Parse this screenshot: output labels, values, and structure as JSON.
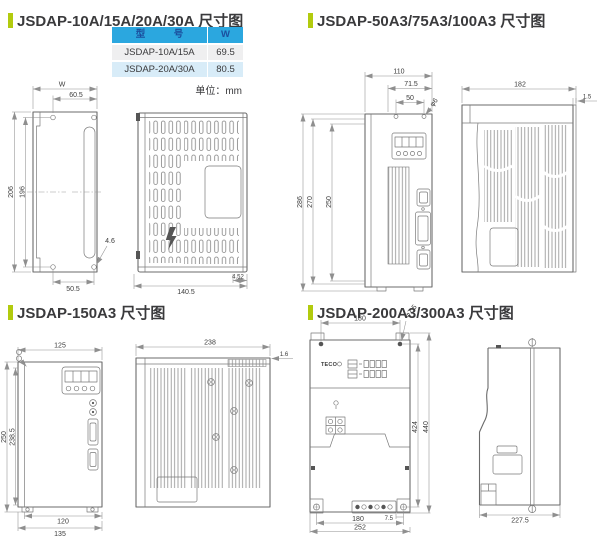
{
  "page": {
    "unit_note": "单位：mm"
  },
  "colors": {
    "accent_bar": "#b2cb0e",
    "table_header_bg": "#2ba7df",
    "table_header_text": "#1b4f9e",
    "table_row_gray": "#efeff0",
    "table_row_blue": "#d8ecf8",
    "drawing_line": "#6b6b6b",
    "text": "#3a3a3c"
  },
  "sections": {
    "s1": {
      "title": "JSDAP-10A/15A/20A/30A 尺寸图",
      "table": {
        "col_model": "型　　　号",
        "col_w": "W",
        "rows": [
          {
            "model": "JSDAP-10A/15A",
            "w": "69.5"
          },
          {
            "model": "JSDAP-20A/30A",
            "w": "80.5"
          }
        ]
      },
      "front": {
        "w": "W",
        "top": "60.5",
        "h_outer": "206",
        "h_inner": "196",
        "hole": "4.6",
        "bottom": "50.5"
      },
      "side": {
        "width": "140.5",
        "foot": "4.52"
      }
    },
    "s2": {
      "title": "JSDAP-50A3/75A3/100A3 尺寸图",
      "front": {
        "w1": "110",
        "w2": "71.5",
        "w3": "50",
        "hole": "φ6",
        "h1": "286",
        "h2": "270",
        "h3": "250"
      },
      "side": {
        "width": "182",
        "lip": "1.5"
      }
    },
    "s3": {
      "title": "JSDAP-150A3 尺寸图",
      "front": {
        "w": "125",
        "h_outer": "250",
        "h_inner": "238.5",
        "b1": "120",
        "b2": "135"
      },
      "side": {
        "width": "238",
        "lip": "1.6"
      }
    },
    "s4": {
      "title": "JSDAP-200A3/300A3 尺寸图",
      "front": {
        "w": "180",
        "hole": "φ7.5",
        "h1": "424",
        "h2": "440",
        "b1": "7.5",
        "b2": "180",
        "b3": "252",
        "logo": "TECO"
      },
      "side": {
        "depth": "227.5"
      }
    }
  }
}
